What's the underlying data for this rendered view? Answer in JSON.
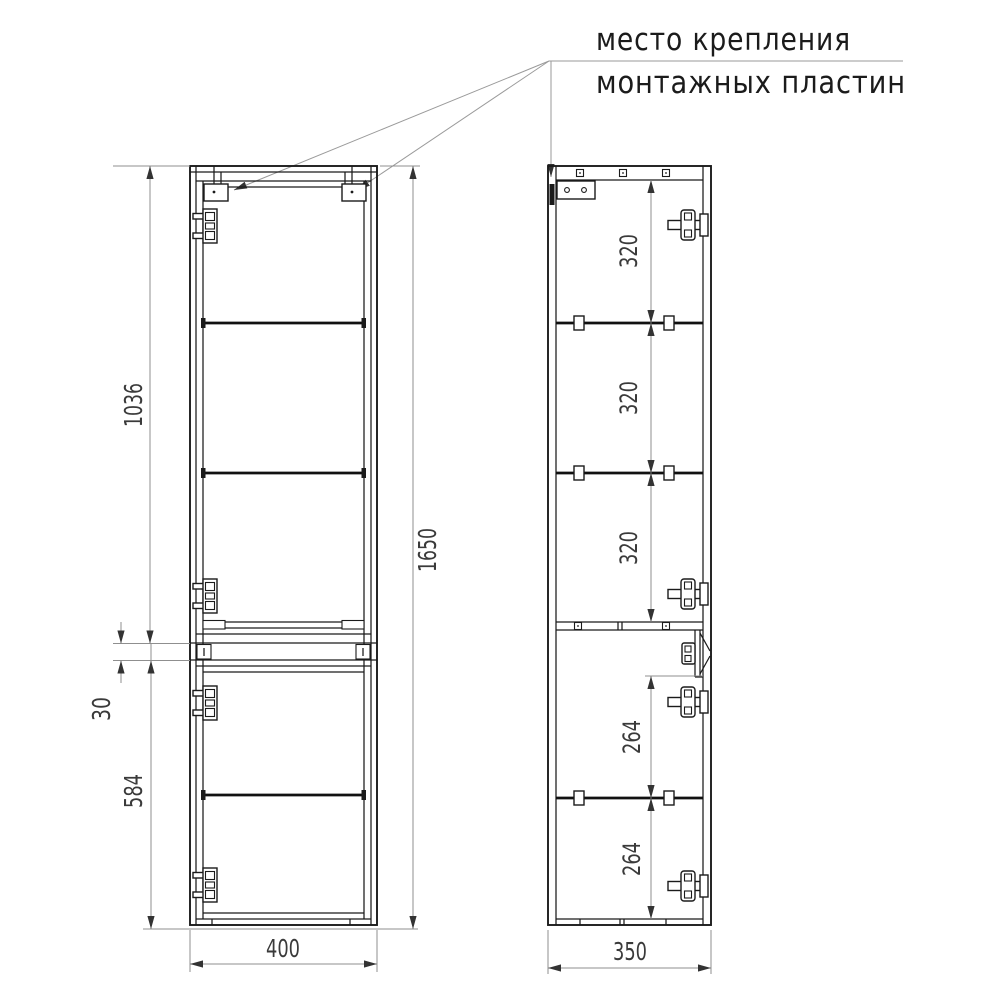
{
  "annotation": {
    "line1": "место крепления",
    "line2": "монтажных пластин"
  },
  "front_view": {
    "dim_upper_height": "1036",
    "dim_gap": "30",
    "dim_lower_height": "584",
    "dim_total_height": "1650",
    "dim_width": "400"
  },
  "side_view": {
    "dim_section_1": "320",
    "dim_section_2": "320",
    "dim_section_3": "320",
    "dim_section_4": "264",
    "dim_section_5": "264",
    "dim_depth": "350"
  },
  "colors": {
    "drawing_line": "#1b1b1b",
    "dimension_line": "#8f8f8f",
    "dimension_text": "#3a3a3a",
    "background": "#ffffff"
  }
}
